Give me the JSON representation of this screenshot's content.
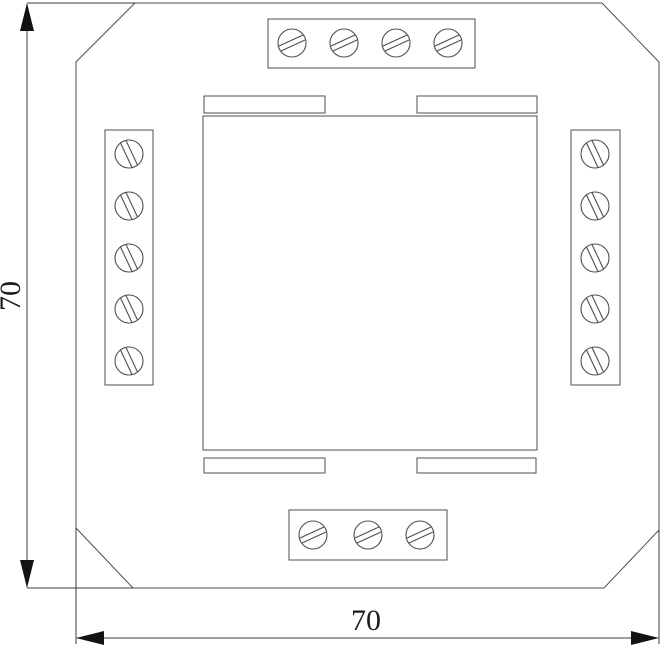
{
  "diagram": {
    "kind": "dimensioned-outline-drawing",
    "subject": "square module with chamfered corners, screw terminal blocks on four sides, central square cover and four thin slots",
    "dimensions": {
      "height": {
        "label": "70"
      },
      "width": {
        "label": "70"
      }
    },
    "terminal_blocks": {
      "top": {
        "screw_count": 4
      },
      "left": {
        "screw_count": 5
      },
      "right": {
        "screw_count": 5
      },
      "bottom": {
        "screw_count": 3
      }
    },
    "features": {
      "center_square_count": 1,
      "slot_count": 4,
      "chamfered_corners": 4
    }
  },
  "colors": {
    "line": "#4f4f4f",
    "dim": "#3c3c3c",
    "arrow": "#121212",
    "text": "#1c1c1c",
    "background": "#ffffff"
  }
}
